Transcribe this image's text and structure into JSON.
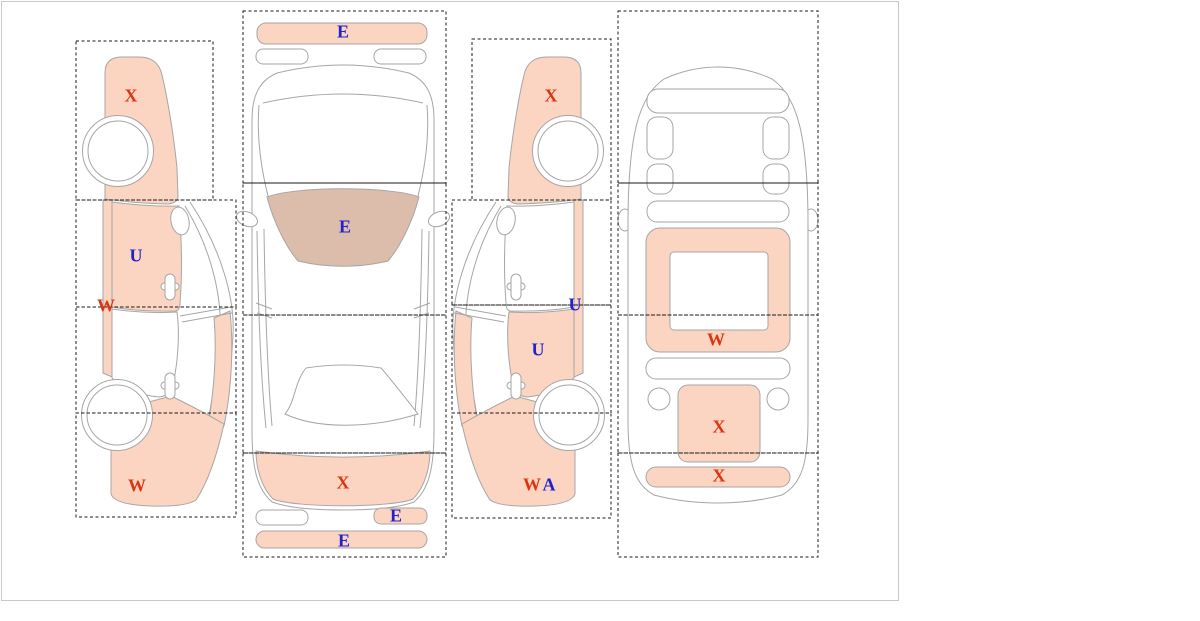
{
  "palette": {
    "highlight": "#fbd5c2",
    "glass": "#dcbcab",
    "outline": "#a6a6a6",
    "dash": "#1a1a1a",
    "border": "#c9c9c9",
    "red": "#dd3311",
    "blue": "#2222cc"
  },
  "markers": [
    {
      "view": "left-side",
      "part": "front-fender",
      "code": "X",
      "color": "#dd3311"
    },
    {
      "view": "left-side",
      "part": "front-door",
      "code": "U",
      "color": "#2222cc"
    },
    {
      "view": "left-side",
      "part": "rocker-panel",
      "code": "W",
      "color": "#dd3311"
    },
    {
      "view": "left-side",
      "part": "rear-quarter",
      "code": "W",
      "color": "#dd3311"
    },
    {
      "view": "top",
      "part": "front-bumper",
      "code": "E",
      "color": "#2222cc"
    },
    {
      "view": "top",
      "part": "windshield",
      "code": "E",
      "color": "#2222cc"
    },
    {
      "view": "top",
      "part": "rear-deck",
      "code": "X",
      "color": "#dd3311"
    },
    {
      "view": "top",
      "part": "taillight-right",
      "code": "E",
      "color": "#2222cc"
    },
    {
      "view": "top",
      "part": "rear-bumper",
      "code": "E",
      "color": "#2222cc"
    },
    {
      "view": "right-side",
      "part": "front-fender",
      "code": "X",
      "color": "#dd3311"
    },
    {
      "view": "right-side",
      "part": "rocker-panel",
      "code": "U",
      "color": "#2222cc"
    },
    {
      "view": "right-side",
      "part": "rear-door",
      "code": "U",
      "color": "#2222cc"
    },
    {
      "view": "right-side",
      "part": "rear-quarter-w",
      "code": "W",
      "color": "#dd3311"
    },
    {
      "view": "right-side",
      "part": "rear-quarter-a",
      "code": "A",
      "color": "#2222cc"
    },
    {
      "view": "rear",
      "part": "rear-window-frame",
      "code": "W",
      "color": "#dd3311"
    },
    {
      "view": "rear",
      "part": "trunk",
      "code": "X",
      "color": "#dd3311"
    },
    {
      "view": "rear",
      "part": "rear-bumper",
      "code": "X",
      "color": "#dd3311"
    }
  ]
}
